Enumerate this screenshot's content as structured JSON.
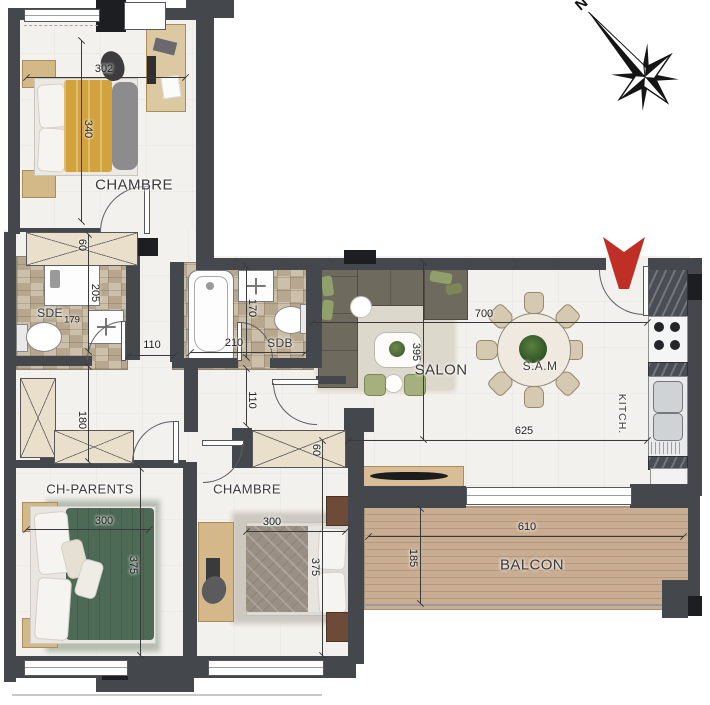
{
  "rooms": {
    "chambre1": {
      "label": "CHAMBRE"
    },
    "sde": {
      "label": "SDE"
    },
    "sdb": {
      "label": "SDB"
    },
    "salon": {
      "label": "SALON"
    },
    "sam": {
      "label": "S.A.M"
    },
    "kitchen": {
      "label": "KITCH."
    },
    "ch_parents": {
      "label": "CH-PARENTS"
    },
    "chambre2": {
      "label": "CHAMBRE"
    },
    "balcon": {
      "label": "BALCON"
    }
  },
  "dims": {
    "d302": "302",
    "d340": "340",
    "d60a": "60",
    "d205": "205",
    "d179": "179",
    "d110a": "110",
    "d170": "170",
    "d210": "210",
    "d110b": "110",
    "d180": "180",
    "d700": "700",
    "d395": "395",
    "d625": "625",
    "d300a": "300",
    "d375a": "375",
    "d300b": "300",
    "d375b": "375",
    "d60b": "60",
    "d610": "610",
    "d185": "185"
  },
  "compass": {
    "north": "N"
  },
  "colors": {
    "wall": "#44474c",
    "entry_arrow": "#bf2f26",
    "balcony_deck": "#c9ad92",
    "bed1_duvet": "#d2a23d",
    "bed_parents_duvet": "#4d6a56",
    "bed2_duvet": "#998f83",
    "sofa": "#6f6a5e",
    "bath_tile": "#c5b8a2"
  }
}
